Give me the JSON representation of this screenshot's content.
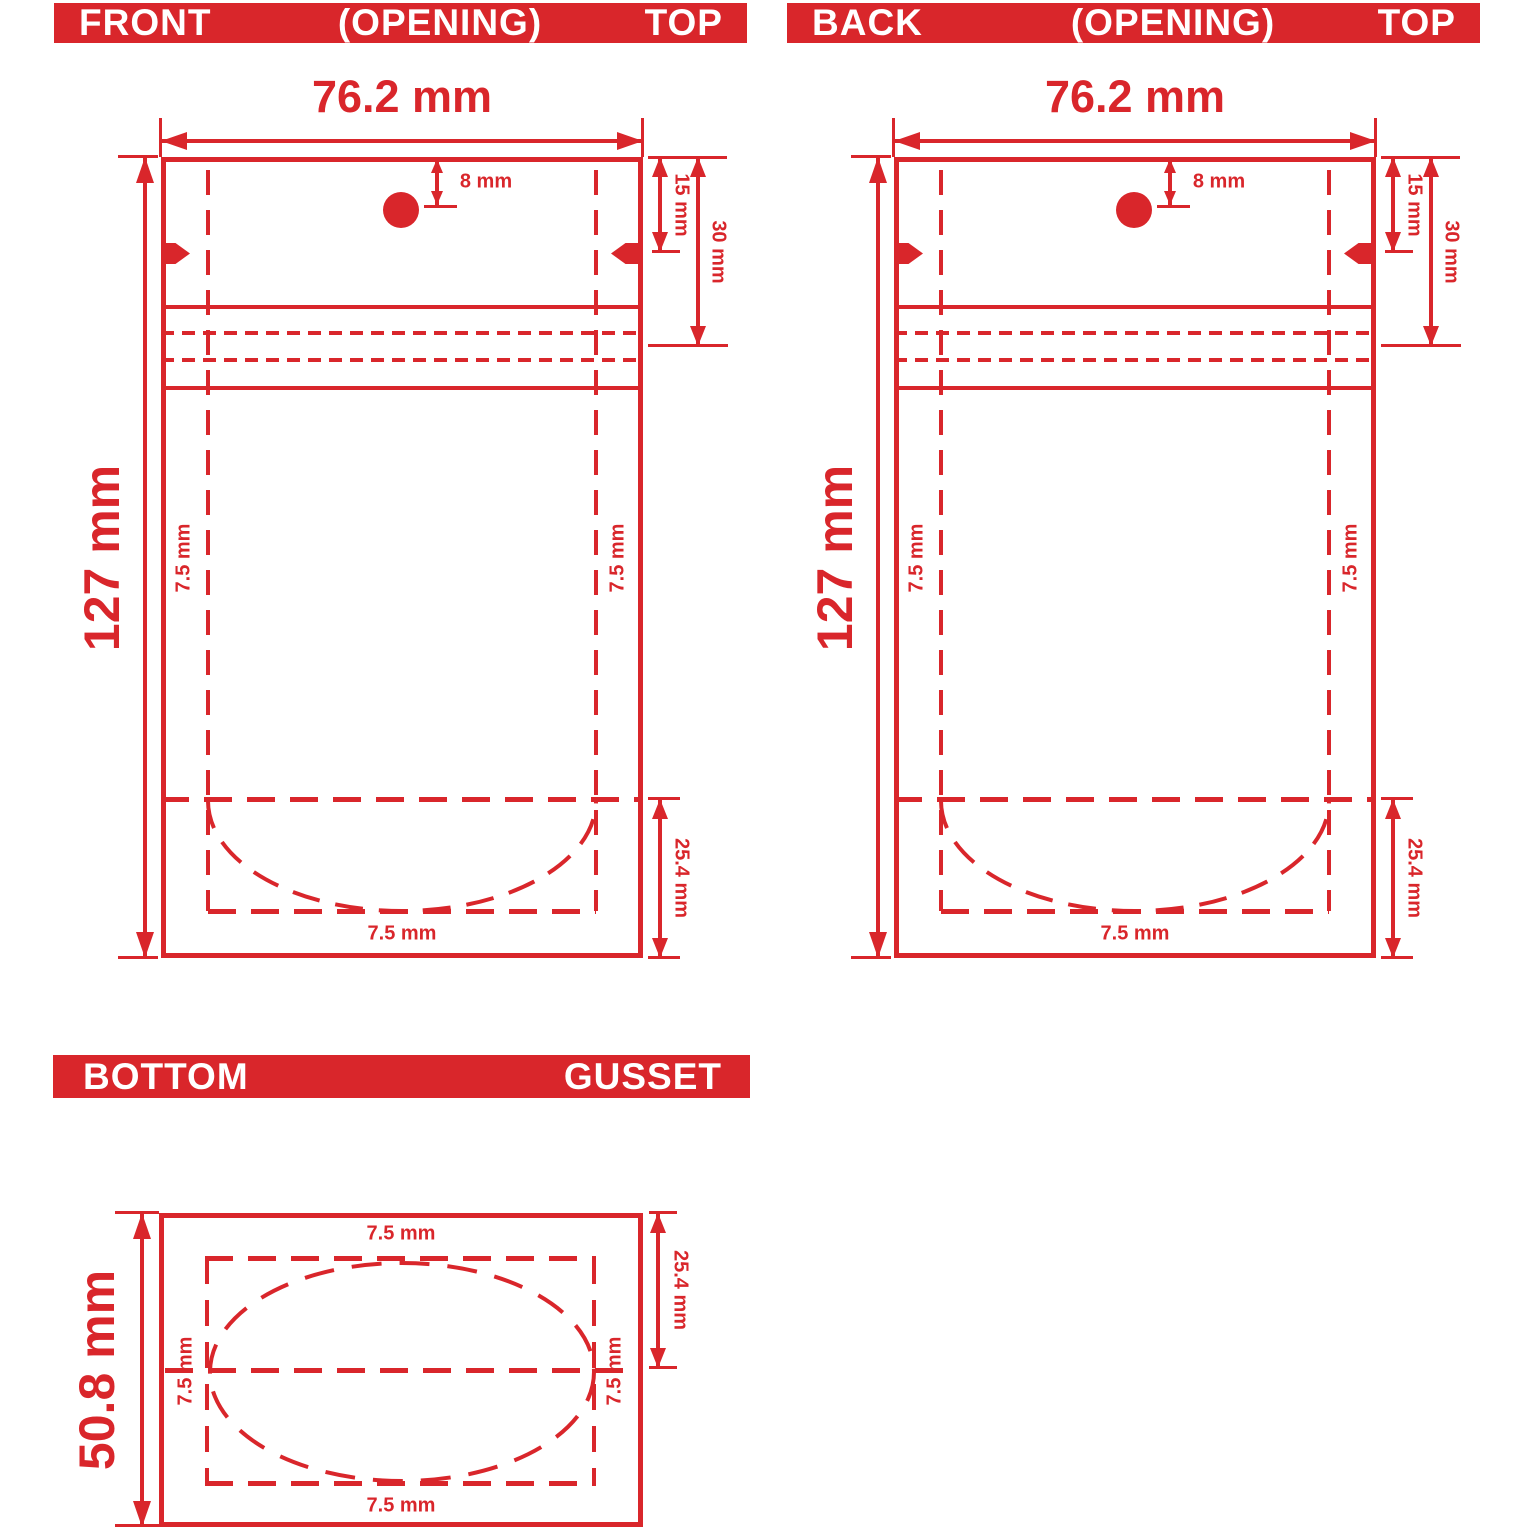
{
  "colors": {
    "dieline_red": "#d9262b",
    "header_text": "#ffffff",
    "background": "#ffffff"
  },
  "front": {
    "header": {
      "left": "FRONT",
      "center": "(OPENING)",
      "right": "TOP"
    },
    "labels": {
      "width": "76.2 mm",
      "height": "127 mm",
      "hole_offset": "8 mm",
      "notch_depth": "15 mm",
      "zipper_depth": "30 mm",
      "left_seal": "7.5 mm",
      "right_seal": "7.5 mm",
      "bottom_seal": "7.5 mm",
      "gusset_depth": "25.4 mm"
    }
  },
  "back": {
    "header": {
      "left": "BACK",
      "center": "(OPENING)",
      "right": "TOP"
    },
    "labels": {
      "width": "76.2 mm",
      "height": "127 mm",
      "hole_offset": "8 mm",
      "notch_depth": "15 mm",
      "zipper_depth": "30 mm",
      "left_seal": "7.5 mm",
      "right_seal": "7.5 mm",
      "bottom_seal": "7.5 mm",
      "gusset_depth": "25.4 mm"
    }
  },
  "bottom_gusset": {
    "header": {
      "left": "BOTTOM",
      "right": "GUSSET"
    },
    "labels": {
      "height": "50.8 mm",
      "half_depth": "25.4 mm",
      "top_seal": "7.5 mm",
      "bottom_seal": "7.5 mm",
      "left_seal": "7.5 mm",
      "right_seal": "7.5 mm"
    }
  }
}
